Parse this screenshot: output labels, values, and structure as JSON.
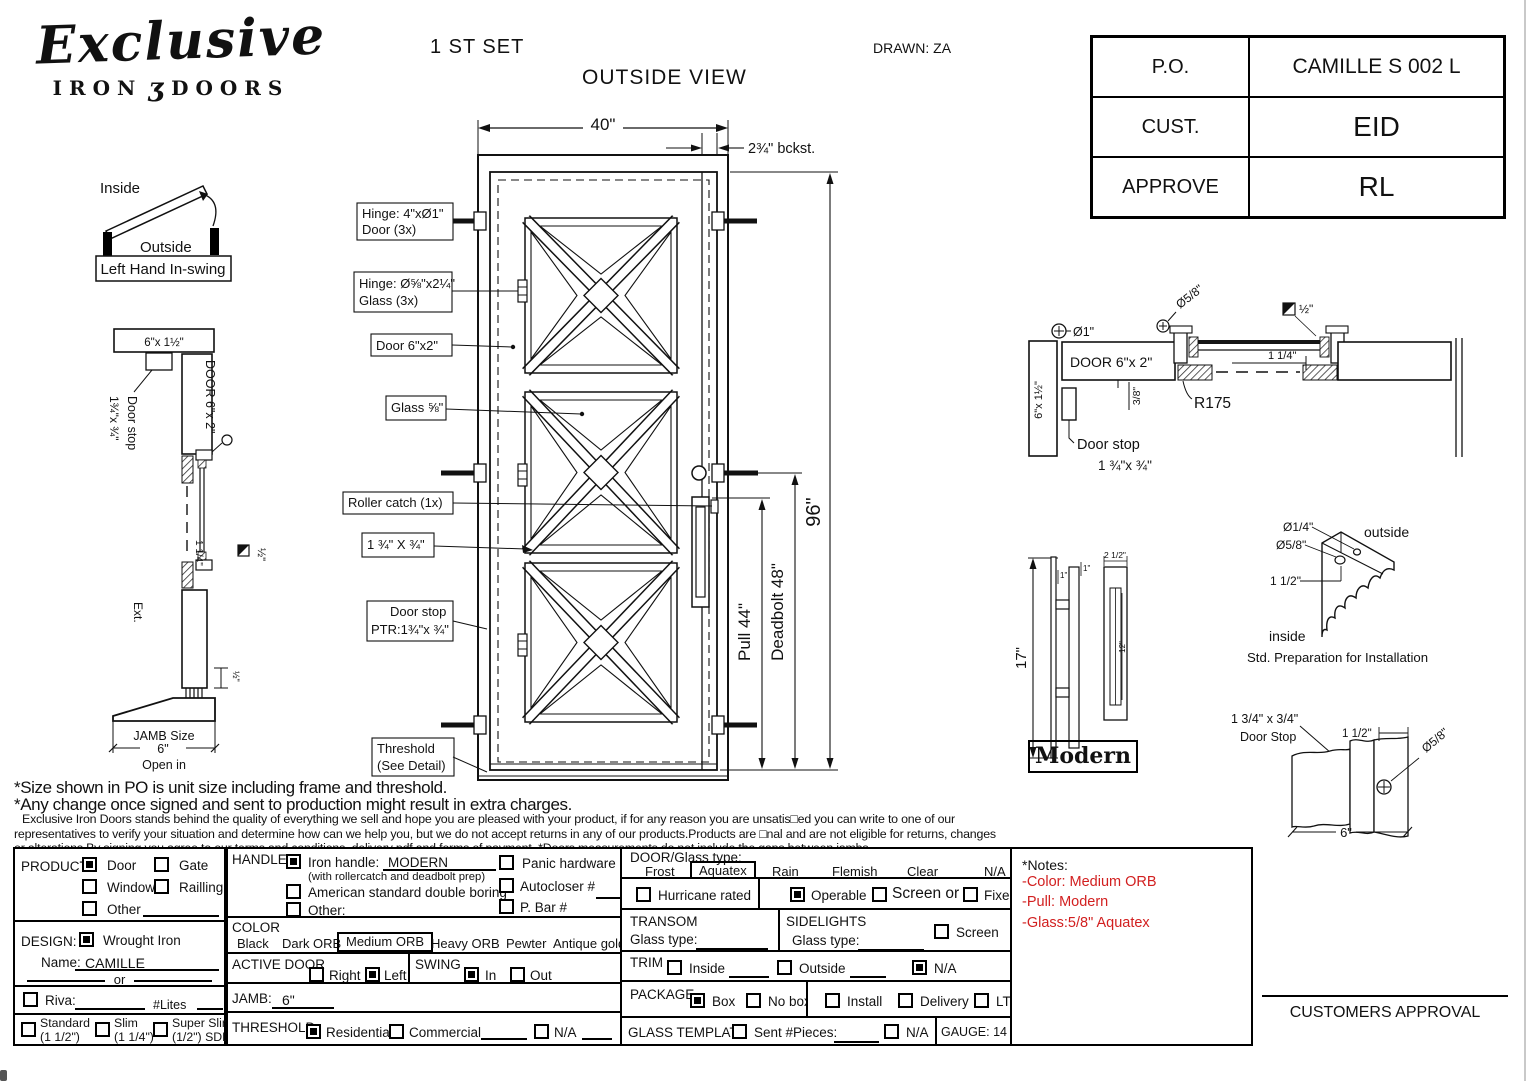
{
  "page": {
    "set_label": "1 ST SET",
    "view_label": "OUTSIDE VIEW",
    "drawn_label": "DRAWN: ZA"
  },
  "logo": {
    "name": "Exclusive",
    "sub_left": "IRON",
    "ornament": "ʒ",
    "sub_right": "DOORS"
  },
  "po_table": {
    "rows": [
      {
        "label": "P.O.",
        "value": "CAMILLE S 002 L"
      },
      {
        "label": "CUST.",
        "value": "EID"
      },
      {
        "label": "APPROVE",
        "value": "RL"
      }
    ]
  },
  "swing": {
    "inside": "Inside",
    "outside": "Outside",
    "caption": "Left Hand In-swing"
  },
  "left_section": {
    "head_label": "6\"x 1½\"",
    "door_label": "DOOR 6\"x 2\"",
    "door_stop_line1": "Door stop",
    "door_stop_line2": "1¾\"x ¾\"",
    "dim_1_1_4": "1 1/4\"",
    "dim_half_sq": "½\"",
    "ext_label": "Ext.",
    "dim_half": "½\"",
    "jamb_line1": "JAMB Size",
    "jamb_line2": "6\"",
    "open_in": "Open in"
  },
  "elevation": {
    "width_dim": "40\"",
    "backset_dim": "2¾\" bckst.",
    "callout_hinge_door_1": "Hinge: 4\"xØ1\"",
    "callout_hinge_door_2": "Door (3x)",
    "callout_hinge_glass_1": "Hinge: Ø⅝\"x2¼\"",
    "callout_hinge_glass_2": "Glass (3x)",
    "callout_door": "Door 6\"x2\"",
    "callout_glass": "Glass ⅝\"",
    "callout_roller": "Roller catch  (1x)",
    "callout_stile": "1 ¾\" X ¾\"",
    "callout_door_stop_1": "Door stop",
    "callout_door_stop_2": "PTR:1¾\"x ¾\"",
    "callout_threshold_1": "Threshold",
    "callout_threshold_2": "(See Detail)",
    "pull_dim": "Pull 44\"",
    "deadbolt_dim": "Deadbolt 48\"",
    "height_dim": "96\""
  },
  "head_section": {
    "dia_1": "Ø1\"",
    "dia_58": "Ø5/8\"",
    "half_sq": "½\"",
    "wall_label": "6\"x 1½\"",
    "door_label": "DOOR 6\"x 2\"",
    "dim_1_1_4": "1 1/4\"",
    "dim_38": "3/8\"",
    "r175": "R175",
    "door_stop_1": "Door stop",
    "door_stop_2": "1 ¾\"x ¾\""
  },
  "handle_detail": {
    "height": "17\"",
    "one_a": "1\"",
    "one_b": "1\"",
    "width": "2 1/2\"",
    "inner": "12\"",
    "caption": "Modern"
  },
  "std_prep": {
    "dia_14": "Ø1/4\"",
    "dia_58": "Ø5/8\"",
    "dim_112": "1 1/2\"",
    "outside": "outside",
    "inside": "inside",
    "caption": "Std. Preparation for Installation"
  },
  "stop_detail": {
    "size": "1 3/4\" x 3/4\"",
    "name": "Door Stop",
    "dim_112": "1 1/2\"",
    "dia_58": "Ø5/8\"",
    "dim_6": "6\""
  },
  "footnotes": {
    "line1": "*Size shown in PO is unit size including frame and threshold.",
    "line2": "*Any change once signed and sent to production might result in extra charges.",
    "line3": "Exclusive Iron Doors stands behind the quality of everything we sell and hope you are pleased with your product, if for any reason you are unsatis□ed you can write to one of our",
    "line4": "representatives to verify your situation and determine how can we help you, but we do not accept returns in any of our products.Products are □nal and are not eligible for returns, changes",
    "line5": "or alterations.By signing you agree to our terms and conditions, delivery pdf and forms of payment. *Doors measurements do not include the gaps between jambs"
  },
  "form": {
    "product": {
      "label": "PRODUCT:",
      "door": "Door",
      "gate": "Gate",
      "window": "Window",
      "railling": "Railling",
      "other": "Other"
    },
    "design": {
      "label": "DESIGN:",
      "wrought": "Wrought Iron",
      "name_label": "Name:",
      "name_value": "CAMILLE",
      "or_label": "or"
    },
    "riva": {
      "label": "Riva:",
      "lites": "#Lites"
    },
    "frame": {
      "standard": "Standard",
      "standard_sub": "(1 1/2\")",
      "slim": "Slim",
      "slim_sub": "(1 1/4\")",
      "super": "Super Slim",
      "super_sub": "(1/2\") SDL"
    },
    "handle": {
      "label": "HANDLE",
      "iron": "Iron handle:",
      "iron_value": "MODERN",
      "iron_sub": "(with rollercatch and deadbolt prep)",
      "american": "American standard double boring",
      "other": "Other:",
      "panic": "Panic hardware",
      "autocloser": "Autocloser #",
      "pbar": "P. Bar #"
    },
    "color": {
      "label": "COLOR",
      "black": "Black",
      "dark": "Dark ORB",
      "medium": "Medium ORB",
      "heavy": "Heavy ORB",
      "pewter": "Pewter",
      "antique": "Antique gold"
    },
    "active_door": {
      "label": "ACTIVE DOOR",
      "right": "Right",
      "left": "Left"
    },
    "swing": {
      "label": "SWING",
      "in": "In",
      "out": "Out"
    },
    "jamb": {
      "label": "JAMB:",
      "value": "6\""
    },
    "threshold": {
      "label": "THRESHOLD",
      "residential": "Residential",
      "commercial": "Commercial",
      "na": "N/A"
    },
    "glass": {
      "label": "DOOR/Glass type:",
      "frost": "Frost",
      "aquatex": "Aquatex",
      "rain": "Rain",
      "flemish": "Flemish",
      "clear": "Clear",
      "na": "N/A"
    },
    "options_row": {
      "hurricane": "Hurricane rated",
      "operable": "Operable",
      "screen_or": "Screen or",
      "fixed": "Fixed"
    },
    "transom": {
      "label": "TRANSOM",
      "glass_label": "Glass type:"
    },
    "sidelights": {
      "label": "SIDELIGHTS",
      "glass_label": "Glass type:",
      "screen": "Screen"
    },
    "trim": {
      "label": "TRIM",
      "inside": "Inside",
      "outside": "Outside",
      "na": "N/A"
    },
    "package": {
      "label": "PACKAGE",
      "box": "Box",
      "nobox": "No box",
      "install": "Install",
      "delivery": "Delivery",
      "ltl": "LTL"
    },
    "glass_template": {
      "label": "GLASS TEMPLATE",
      "sent": "Sent #Pieces:",
      "na": "N/A"
    },
    "gauge": {
      "label": "GAUGE: 14"
    },
    "checks": {
      "product_door": true,
      "design_wrought": true,
      "handle_iron": true,
      "active_left": true,
      "swing_in": true,
      "threshold_residential": true,
      "operable": true,
      "trim_na": true,
      "package_box": true
    }
  },
  "notes_box": {
    "title": "*Notes:",
    "line1": "-Color: Medium ORB",
    "line2": "-Pull: Modern",
    "line3": "-Glass:5/8\"  Aquatex",
    "color": "#d22020"
  },
  "approval": {
    "label": "CUSTOMERS APPROVAL"
  }
}
